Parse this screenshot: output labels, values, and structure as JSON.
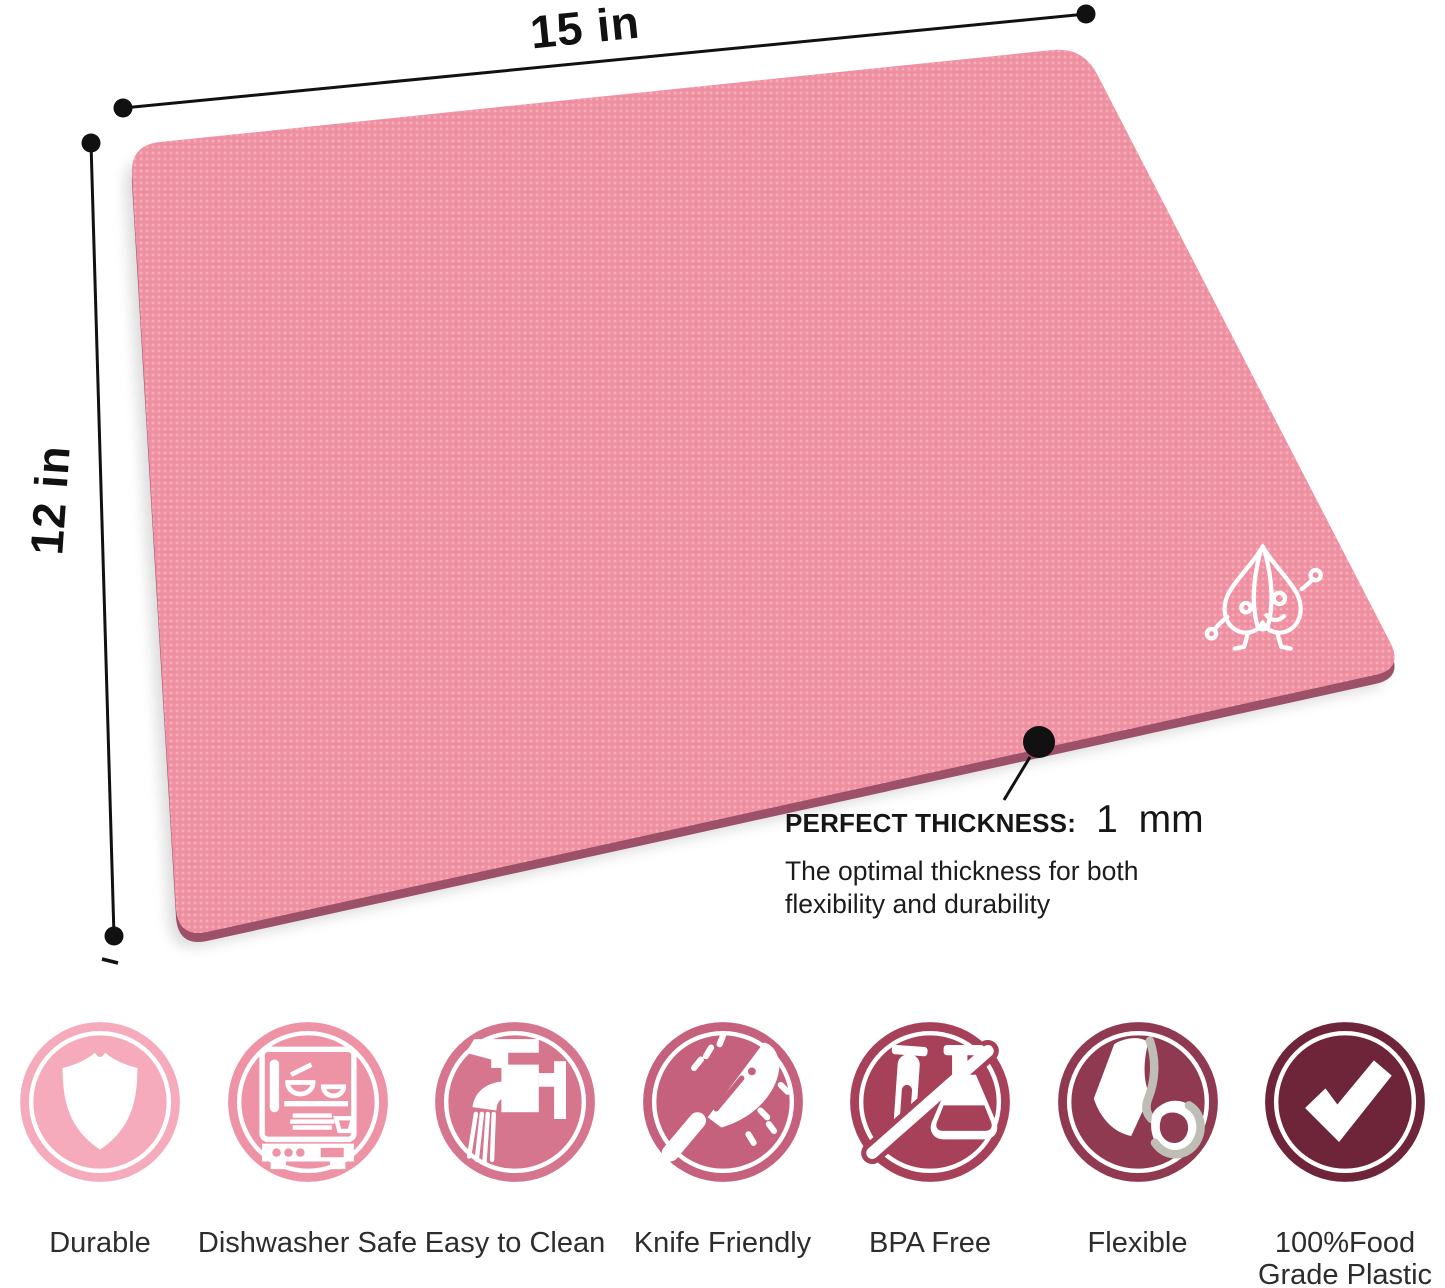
{
  "product": {
    "name": "flexible cutting mat",
    "mat_color": "#EE90A1",
    "mat_texture_dot_color": "#F7B3BF",
    "mat_edge_color": "#9C5168",
    "logo": "garlic-mascot"
  },
  "dimensions": {
    "width_label": "15 in",
    "height_label": "12 in"
  },
  "callout": {
    "title": "PERFECT THICKNESS:",
    "value": "1 mm",
    "description_line1": "The optimal thickness for both",
    "description_line2": "flexibility and durability"
  },
  "features": {
    "items": [
      {
        "label": "Durable",
        "icon": "shield-icon",
        "color": "#F5ABBC"
      },
      {
        "label": "Dishwasher Safe",
        "icon": "dishwasher-icon",
        "color": "#EE92A6"
      },
      {
        "label": "Easy to Clean",
        "icon": "faucet-icon",
        "color": "#D5758E"
      },
      {
        "label": "Knife Friendly",
        "icon": "knife-icon",
        "color": "#C5617D"
      },
      {
        "label": "BPA Free",
        "icon": "no-bpa-icon",
        "color": "#A7415A"
      },
      {
        "label": "Flexible",
        "icon": "flexible-mat-icon",
        "color": "#8F3A51"
      },
      {
        "label": "100%Food Grade Plastic",
        "icon": "checkmark-icon",
        "color": "#6F2539"
      }
    ]
  }
}
